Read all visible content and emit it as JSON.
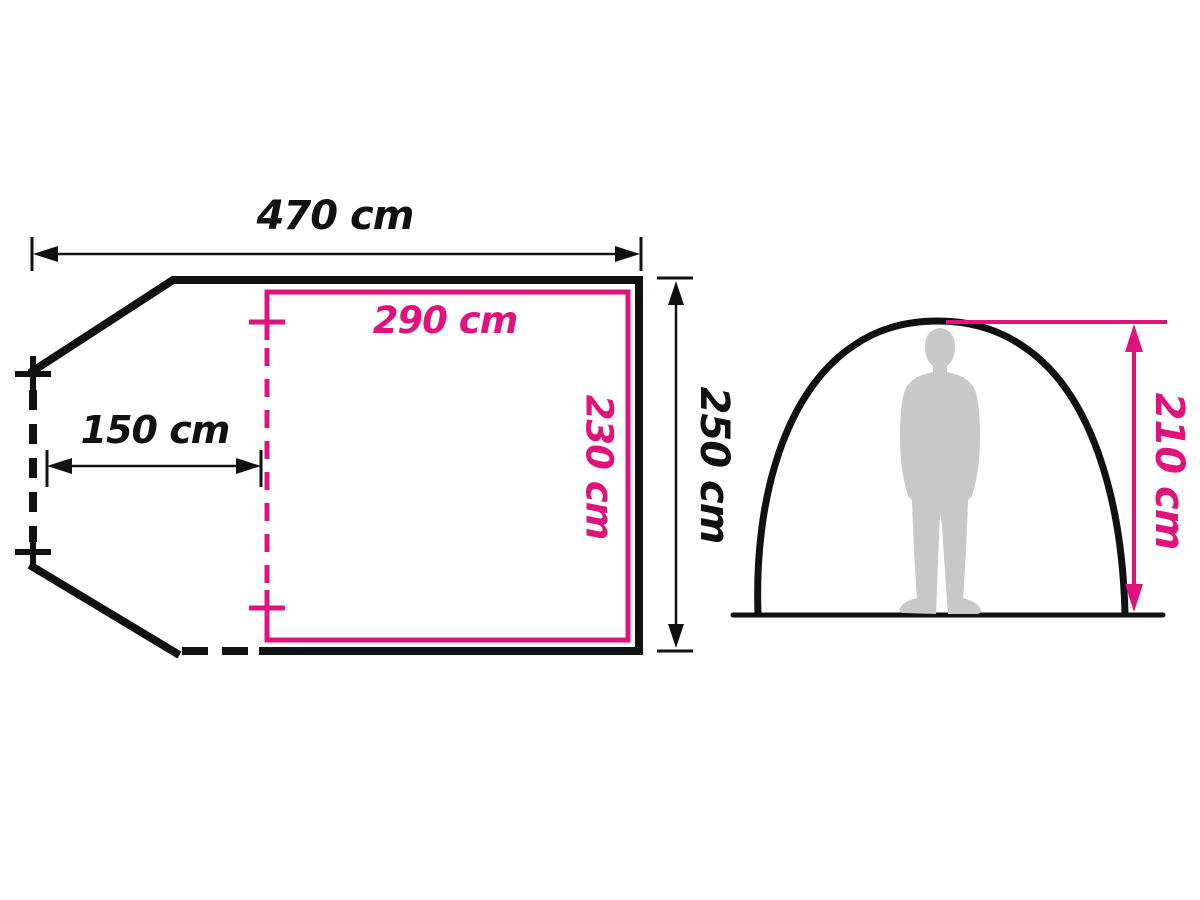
{
  "figure": {
    "type": "tent-dimensions-diagram",
    "floor_plan": {
      "total_width_label": "470 cm",
      "vestibule_depth_label": "150 cm",
      "total_depth_label": "250 cm",
      "inner_room_width_label": "290 cm",
      "inner_room_depth_label": "230 cm"
    },
    "side_view": {
      "peak_height_label": "210 cm"
    }
  },
  "colors": {
    "pink": "#e0137c",
    "black": "#111111",
    "person_gray": "#c8c8c8",
    "background": "#ffffff"
  }
}
